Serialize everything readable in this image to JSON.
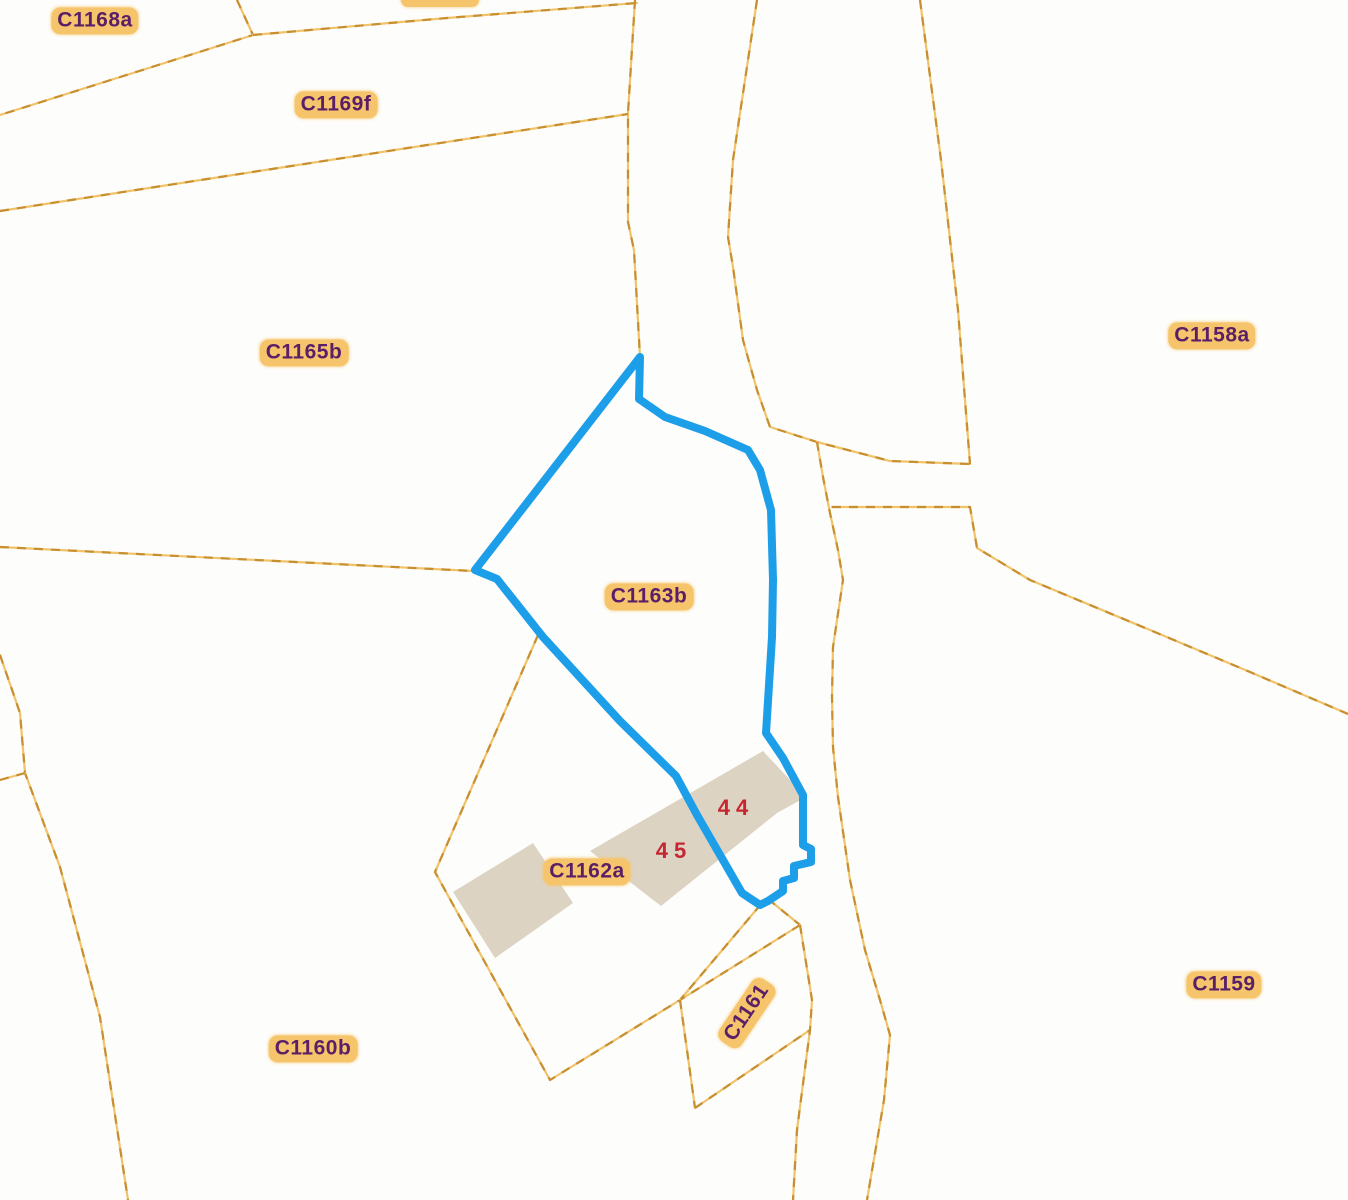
{
  "map": {
    "title": "cadastral-parcel-map",
    "selected_parcel": "C1163b",
    "colors": {
      "background": "#fdfdfb",
      "boundary_dash_dark": "#c78f2f",
      "boundary_dash_light": "#f0c36a",
      "highlight_stroke": "#1d9ee9",
      "building_fill": "#ddd3c2",
      "label_text": "#5b1f68",
      "label_halo": "#f6c56b",
      "house_number_color": "#c62631"
    },
    "parcel_labels": [
      {
        "id": "c1168a",
        "text": "C1168a",
        "x": 95,
        "y": 21,
        "rotation": 0
      },
      {
        "id": "c1169f",
        "text": "C1169f",
        "x": 336,
        "y": 105,
        "rotation": 0
      },
      {
        "id": "c1165b",
        "text": "C1165b",
        "x": 304,
        "y": 353,
        "rotation": 0
      },
      {
        "id": "c1158a",
        "text": "C1158a",
        "x": 1212,
        "y": 336,
        "rotation": 0
      },
      {
        "id": "c1163b",
        "text": "C1163b",
        "x": 649,
        "y": 597,
        "rotation": 0
      },
      {
        "id": "c1162a",
        "text": "C1162a",
        "x": 587,
        "y": 872,
        "rotation": 0
      },
      {
        "id": "c1160b",
        "text": "C1160b",
        "x": 313,
        "y": 1049,
        "rotation": 0
      },
      {
        "id": "c1159",
        "text": "C1159",
        "x": 1224,
        "y": 985,
        "rotation": 0
      },
      {
        "id": "c1161",
        "text": "C1161",
        "x": 747,
        "y": 1013,
        "rotation": -56
      }
    ],
    "house_numbers": [
      {
        "id": "house-44",
        "text": "44",
        "x": 736,
        "y": 808
      },
      {
        "id": "house-45",
        "text": "45",
        "x": 674,
        "y": 851
      }
    ],
    "partial_label_top": {
      "x": 440,
      "y": -9,
      "width": 78,
      "height": 16
    },
    "highlight_polygon": {
      "name": "selected-parcel-outline",
      "points": [
        [
          640,
          357
        ],
        [
          639,
          399
        ],
        [
          665,
          417
        ],
        [
          705,
          431
        ],
        [
          748,
          450
        ],
        [
          760,
          470
        ],
        [
          771,
          510
        ],
        [
          773,
          580
        ],
        [
          772,
          637
        ],
        [
          766,
          733
        ],
        [
          783,
          758
        ],
        [
          803,
          795
        ],
        [
          803,
          845
        ],
        [
          811,
          849
        ],
        [
          811,
          862
        ],
        [
          794,
          866
        ],
        [
          794,
          878
        ],
        [
          783,
          881
        ],
        [
          783,
          891
        ],
        [
          768,
          901
        ],
        [
          760,
          905
        ],
        [
          742,
          893
        ],
        [
          697,
          815
        ],
        [
          676,
          776
        ],
        [
          620,
          721
        ],
        [
          543,
          637
        ],
        [
          497,
          579
        ],
        [
          475,
          570
        ]
      ]
    },
    "buildings": [
      {
        "name": "building-45-west",
        "points": [
          [
            453,
            892
          ],
          [
            533,
            843
          ],
          [
            573,
            903
          ],
          [
            495,
            958
          ]
        ]
      },
      {
        "name": "building-44-45-band",
        "points": [
          [
            590,
            851
          ],
          [
            763,
            751
          ],
          [
            806,
            797
          ],
          [
            777,
            813
          ],
          [
            661,
            906
          ]
        ]
      }
    ],
    "boundary_lines": [
      {
        "name": "boundary-nw-vertical",
        "points": [
          [
            237,
            0
          ],
          [
            253,
            35
          ],
          [
            0,
            115
          ]
        ]
      },
      {
        "name": "boundary-nw-top",
        "points": [
          [
            253,
            35
          ],
          [
            447,
            18
          ],
          [
            637,
            3
          ]
        ]
      },
      {
        "name": "road-west-upper",
        "points": [
          [
            635,
            0
          ],
          [
            628,
            113
          ],
          [
            628,
            222
          ],
          [
            634,
            250
          ],
          [
            640,
            357
          ]
        ]
      },
      {
        "name": "boundary-c1169f-south",
        "points": [
          [
            0,
            211
          ],
          [
            628,
            114
          ]
        ]
      },
      {
        "name": "road-east-upper",
        "points": [
          [
            757,
            0
          ],
          [
            748,
            60
          ],
          [
            733,
            160
          ],
          [
            728,
            237
          ],
          [
            733,
            267
          ],
          [
            743,
            340
          ],
          [
            757,
            390
          ],
          [
            770,
            427
          ],
          [
            817,
            442
          ],
          [
            890,
            461
          ],
          [
            970,
            464
          ]
        ]
      },
      {
        "name": "boundary-c1158a-west",
        "points": [
          [
            920,
            0
          ],
          [
            941,
            160
          ],
          [
            958,
            310
          ],
          [
            965,
            400
          ],
          [
            970,
            464
          ]
        ]
      },
      {
        "name": "road-south-edge",
        "points": [
          [
            832,
            507
          ],
          [
            970,
            507
          ],
          [
            977,
            548
          ],
          [
            1030,
            580
          ],
          [
            1150,
            630
          ],
          [
            1250,
            672
          ],
          [
            1348,
            714
          ]
        ]
      },
      {
        "name": "road-west-lower",
        "points": [
          [
            817,
            442
          ],
          [
            823,
            477
          ],
          [
            830,
            513
          ],
          [
            838,
            550
          ],
          [
            843,
            580
          ],
          [
            833,
            647
          ],
          [
            832,
            697
          ],
          [
            833,
            747
          ],
          [
            838,
            797
          ],
          [
            850,
            880
          ],
          [
            865,
            950
          ],
          [
            880,
            1000
          ],
          [
            890,
            1035
          ],
          [
            884,
            1100
          ],
          [
            867,
            1200
          ]
        ]
      },
      {
        "name": "boundary-c1165b-south",
        "points": [
          [
            0,
            547
          ],
          [
            473,
            571
          ]
        ]
      },
      {
        "name": "boundary-c1162a-west",
        "points": [
          [
            538,
            635
          ],
          [
            435,
            872
          ],
          [
            550,
            1080
          ],
          [
            680,
            1000
          ],
          [
            762,
            903
          ]
        ]
      },
      {
        "name": "c1161-connector",
        "points": [
          [
            768,
            899
          ],
          [
            800,
            925
          ]
        ]
      },
      {
        "name": "c1161-northwest-edge",
        "points": [
          [
            800,
            925
          ],
          [
            680,
            1000
          ]
        ]
      },
      {
        "name": "c1161-southwest-edge",
        "points": [
          [
            680,
            1000
          ],
          [
            687,
            1050
          ],
          [
            695,
            1108
          ]
        ]
      },
      {
        "name": "c1161-south-edge",
        "points": [
          [
            695,
            1108
          ],
          [
            810,
            1030
          ]
        ]
      },
      {
        "name": "c1161-east-edge",
        "points": [
          [
            800,
            925
          ],
          [
            812,
            1000
          ],
          [
            810,
            1030
          ],
          [
            797,
            1130
          ],
          [
            793,
            1200
          ]
        ]
      },
      {
        "name": "boundary-sw-long",
        "points": [
          [
            0,
            655
          ],
          [
            20,
            713
          ],
          [
            25,
            773
          ],
          [
            60,
            867
          ],
          [
            100,
            1017
          ],
          [
            128,
            1200
          ]
        ]
      },
      {
        "name": "boundary-sw-stub",
        "points": [
          [
            0,
            780
          ],
          [
            25,
            773
          ]
        ]
      }
    ]
  }
}
